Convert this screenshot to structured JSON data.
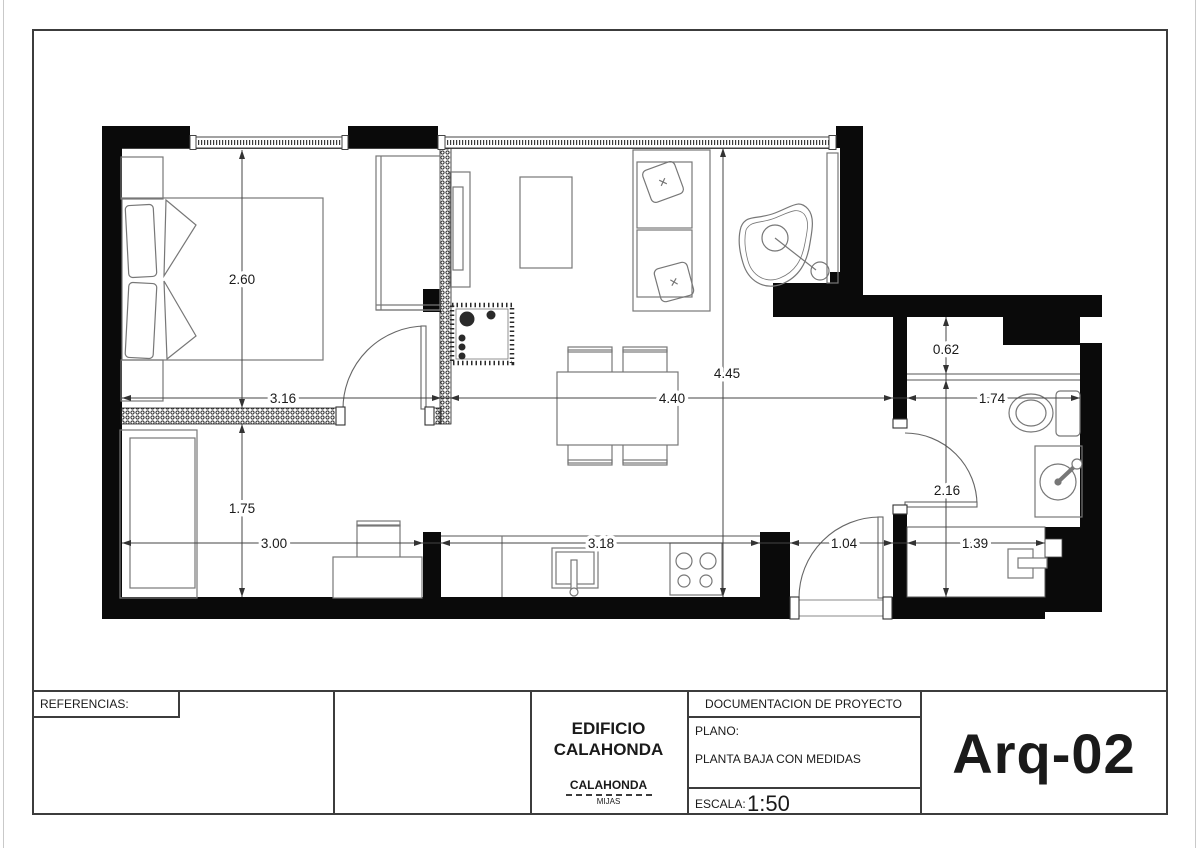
{
  "title_block": {
    "references_label": "REFERENCIAS:",
    "building_line1": "EDIFICIO",
    "building_line2": "CALAHONDA",
    "location_name": "CALAHONDA",
    "location_sub": "MIJAS",
    "doc_header": "DOCUMENTACION DE PROYECTO",
    "plan_label": "PLANO:",
    "plan_name": "PLANTA BAJA CON MEDIDAS",
    "scale_label": "ESCALA:",
    "scale_value": "1:50",
    "sheet_code": "Arq-02"
  },
  "dims": {
    "bedroom_w": "3.16",
    "bedroom_h": "2.60",
    "living_w": "4.40",
    "living_h": "4.45",
    "bath_w": "1.74",
    "bath_niche": "0.62",
    "bath_h": "2.16",
    "lower_room_w": "3.00",
    "lower_room_h": "1.75",
    "kitchen_w": "3.18",
    "entry_w": "1.04",
    "shower_w": "1.39"
  }
}
